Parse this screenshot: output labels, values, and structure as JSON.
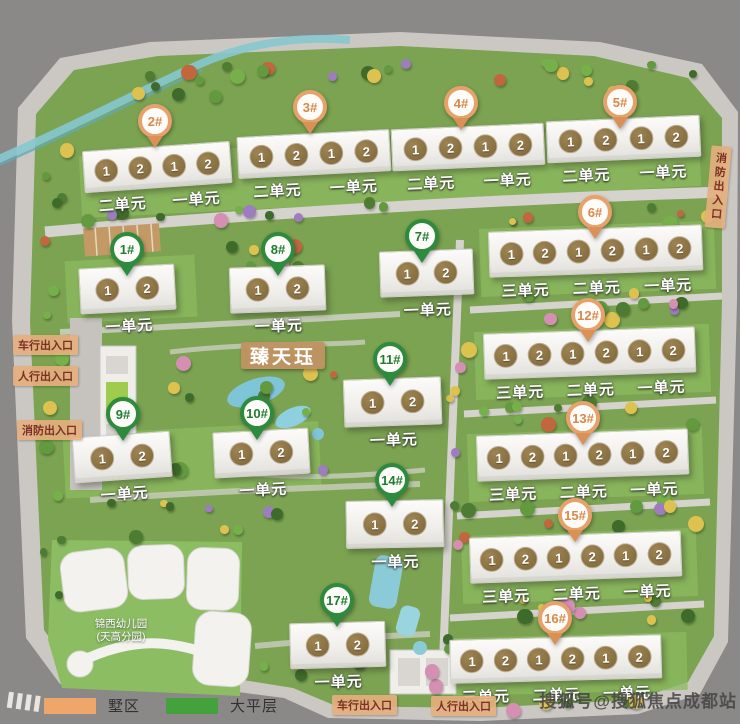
{
  "page": {
    "title": "臻天珏",
    "watermark": "搜狐号@搜狐焦点成都站"
  },
  "legend": {
    "items": [
      {
        "label": "墅区",
        "color": "#efa express-replace"
      },
      {
        "label": "大平层",
        "color": "#44a13b"
      }
    ]
  },
  "kindergarten": {
    "line1": "锦西幼儿园",
    "line2": "(天高分园)"
  },
  "pin_colors": {
    "orange": "#e7a26c",
    "green": "#2e8b3d"
  },
  "unit_circle_color": "#8a7140",
  "entrances": [
    {
      "label": "车行出入口",
      "x": 13,
      "y": 335,
      "orient": "h"
    },
    {
      "label": "人行出入口",
      "x": 13,
      "y": 366,
      "orient": "h"
    },
    {
      "label": "消防出入口",
      "x": 17,
      "y": 420,
      "orient": "h"
    },
    {
      "label": "消防出入口",
      "x": 708,
      "y": 146,
      "orient": "v"
    },
    {
      "label": "车行出入口",
      "x": 332,
      "y": 695,
      "orient": "h"
    },
    {
      "label": "人行出入口",
      "x": 431,
      "y": 696,
      "orient": "h"
    }
  ],
  "buildings": [
    {
      "id": "2#",
      "color": "orange",
      "x": 84,
      "y": 146,
      "w": 148,
      "h": 42,
      "rot": -4,
      "pin": {
        "x": 155,
        "y": 121
      },
      "units": [
        "1",
        "2",
        "1",
        "2"
      ],
      "sections": [
        "二单元",
        "一单元"
      ]
    },
    {
      "id": "3#",
      "color": "orange",
      "x": 238,
      "y": 133,
      "w": 153,
      "h": 42,
      "rot": -3,
      "pin": {
        "x": 310,
        "y": 107
      },
      "units": [
        "1",
        "2",
        "1",
        "2"
      ],
      "sections": [
        "二单元",
        "一单元"
      ]
    },
    {
      "id": "4#",
      "color": "orange",
      "x": 392,
      "y": 126,
      "w": 153,
      "h": 42,
      "rot": -2.5,
      "pin": {
        "x": 461,
        "y": 103
      },
      "units": [
        "1",
        "2",
        "1",
        "2"
      ],
      "sections": [
        "二单元",
        "一单元"
      ]
    },
    {
      "id": "5#",
      "color": "orange",
      "x": 547,
      "y": 118,
      "w": 154,
      "h": 42,
      "rot": -2.5,
      "pin": {
        "x": 620,
        "y": 102
      },
      "units": [
        "1",
        "2",
        "1",
        "2"
      ],
      "sections": [
        "二单元",
        "一单元"
      ]
    },
    {
      "id": "6#",
      "color": "orange",
      "x": 489,
      "y": 228,
      "w": 214,
      "h": 46,
      "rot": -2,
      "pin": {
        "x": 595,
        "y": 212
      },
      "units": [
        "1",
        "2",
        "1",
        "2",
        "1",
        "2"
      ],
      "sections": [
        "三单元",
        "二单元",
        "一单元"
      ]
    },
    {
      "id": "12#",
      "color": "orange",
      "x": 484,
      "y": 330,
      "w": 212,
      "h": 46,
      "rot": -2,
      "pin": {
        "x": 588,
        "y": 315
      },
      "units": [
        "1",
        "2",
        "1",
        "2",
        "1",
        "2"
      ],
      "sections": [
        "三单元",
        "二单元",
        "一单元"
      ]
    },
    {
      "id": "13#",
      "color": "orange",
      "x": 477,
      "y": 432,
      "w": 212,
      "h": 46,
      "rot": -2,
      "pin": {
        "x": 583,
        "y": 418
      },
      "units": [
        "1",
        "2",
        "1",
        "2",
        "1",
        "2"
      ],
      "sections": [
        "三单元",
        "二单元",
        "一单元"
      ]
    },
    {
      "id": "15#",
      "color": "orange",
      "x": 470,
      "y": 534,
      "w": 212,
      "h": 46,
      "rot": -2,
      "pin": {
        "x": 575,
        "y": 515
      },
      "units": [
        "1",
        "2",
        "1",
        "2",
        "1",
        "2"
      ],
      "sections": [
        "三单元",
        "二单元",
        "一单元"
      ]
    },
    {
      "id": "16#",
      "color": "orange",
      "x": 450,
      "y": 637,
      "w": 212,
      "h": 44,
      "rot": -1.5,
      "pin": {
        "x": 555,
        "y": 618
      },
      "units": [
        "1",
        "2",
        "1",
        "2",
        "1",
        "2"
      ],
      "sections": [
        "三单元",
        "二单元",
        "一单元"
      ]
    },
    {
      "id": "1#",
      "color": "green",
      "x": 80,
      "y": 266,
      "w": 96,
      "h": 46,
      "rot": -3,
      "pin": {
        "x": 127,
        "y": 249
      },
      "units": [
        "1",
        "2"
      ],
      "sections": [
        "一单元"
      ]
    },
    {
      "id": "8#",
      "color": "green",
      "x": 230,
      "y": 266,
      "w": 96,
      "h": 46,
      "rot": -2,
      "pin": {
        "x": 278,
        "y": 249
      },
      "units": [
        "1",
        "2"
      ],
      "sections": [
        "一单元"
      ]
    },
    {
      "id": "7#",
      "color": "green",
      "x": 380,
      "y": 250,
      "w": 94,
      "h": 46,
      "rot": -2,
      "pin": {
        "x": 422,
        "y": 236
      },
      "units": [
        "1",
        "2"
      ],
      "sections": [
        "一单元"
      ]
    },
    {
      "id": "9#",
      "color": "green",
      "x": 74,
      "y": 434,
      "w": 98,
      "h": 46,
      "rot": -4,
      "pin": {
        "x": 123,
        "y": 414
      },
      "units": [
        "1",
        "2"
      ],
      "sections": [
        "一单元"
      ]
    },
    {
      "id": "10#",
      "color": "green",
      "x": 214,
      "y": 430,
      "w": 96,
      "h": 46,
      "rot": -3,
      "pin": {
        "x": 257,
        "y": 413
      },
      "units": [
        "1",
        "2"
      ],
      "sections": [
        "一单元"
      ]
    },
    {
      "id": "11#",
      "color": "green",
      "x": 344,
      "y": 378,
      "w": 98,
      "h": 48,
      "rot": -2,
      "pin": {
        "x": 390,
        "y": 359
      },
      "units": [
        "1",
        "2"
      ],
      "sections": [
        "一单元"
      ]
    },
    {
      "id": "14#",
      "color": "green",
      "x": 346,
      "y": 500,
      "w": 98,
      "h": 48,
      "rot": -1,
      "pin": {
        "x": 392,
        "y": 480
      },
      "units": [
        "1",
        "2"
      ],
      "sections": [
        "一单元"
      ]
    },
    {
      "id": "17#",
      "color": "green",
      "x": 290,
      "y": 622,
      "w": 96,
      "h": 46,
      "rot": -1.5,
      "pin": {
        "x": 337,
        "y": 600
      },
      "units": [
        "1",
        "2"
      ],
      "sections": [
        "一单元"
      ]
    }
  ]
}
